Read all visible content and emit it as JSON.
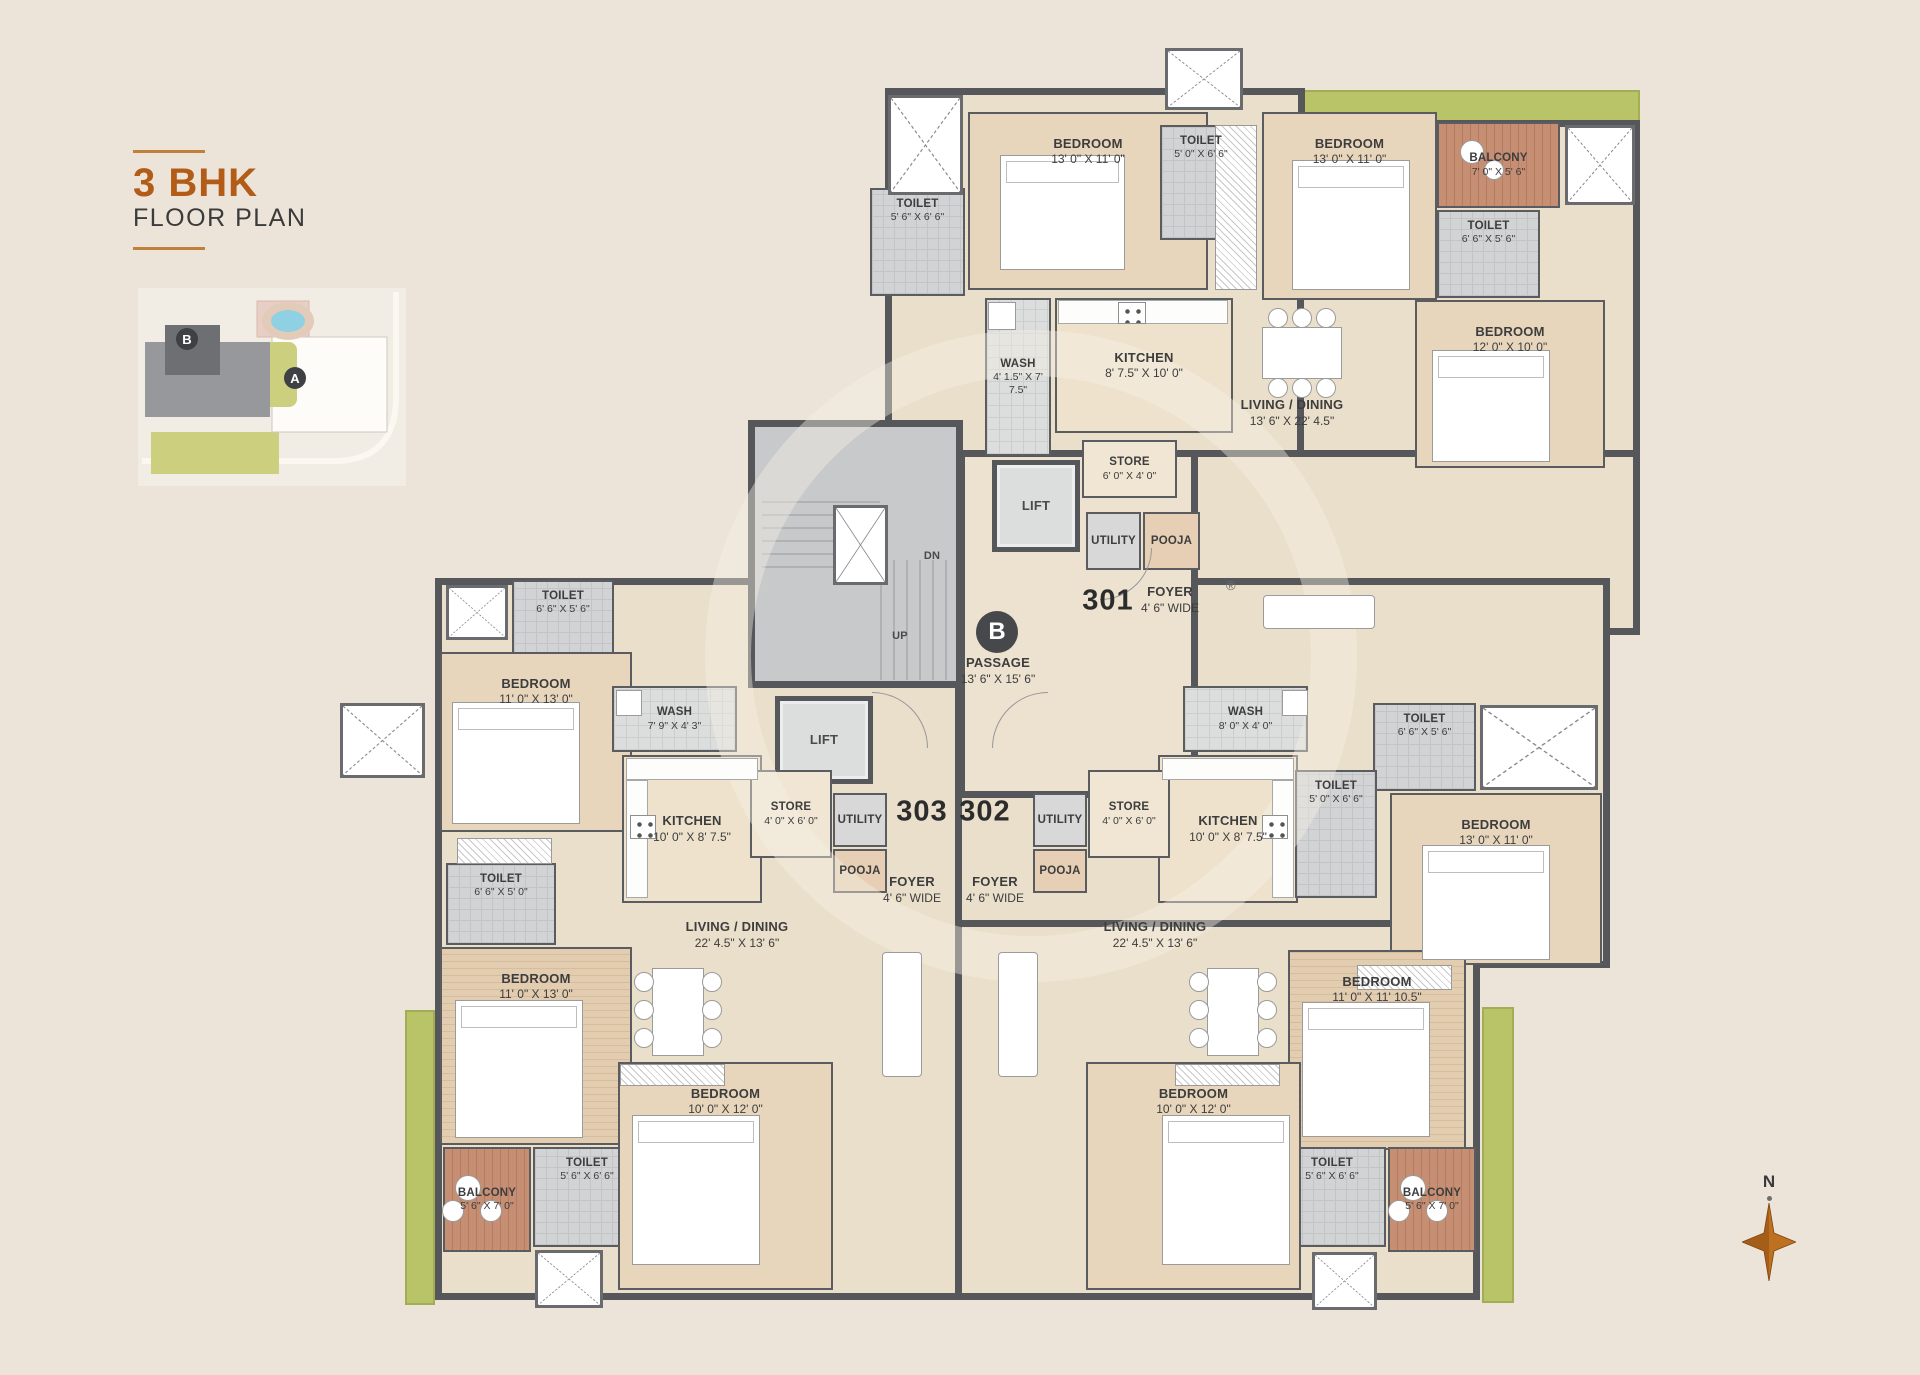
{
  "title": {
    "main": "3 BHK",
    "sub": "FLOOR PLAN"
  },
  "compass": {
    "label": "N"
  },
  "sitemap": {
    "badge_b": "B",
    "badge_a": "A"
  },
  "watermark": {
    "reg": "®"
  },
  "floorplan": {
    "wall_color": "#56575a",
    "accent_orange": "#b35c17",
    "green_color": "#b9c469",
    "rooms": [
      {
        "id": "toilet-301-a",
        "unit": "301",
        "type": "toilet",
        "name": "TOILET",
        "dims": "5' 6\" X 6' 6\"",
        "x": 870,
        "y": 188,
        "w": 95,
        "h": 108
      },
      {
        "id": "bedroom-301-a",
        "unit": "301",
        "type": "bedroom",
        "name": "BEDROOM",
        "dims": "13' 0\" X 11' 0\"",
        "x": 968,
        "y": 112,
        "w": 240,
        "h": 178
      },
      {
        "id": "toilet-301-b",
        "unit": "301",
        "type": "toilet",
        "name": "TOILET",
        "dims": "5' 0\" X 6' 6\"",
        "x": 1160,
        "y": 125,
        "w": 82,
        "h": 115
      },
      {
        "id": "bedroom-301-b",
        "unit": "301",
        "type": "bedroom",
        "name": "BEDROOM",
        "dims": "13' 0\" X 11' 0\"",
        "x": 1262,
        "y": 112,
        "w": 175,
        "h": 188
      },
      {
        "id": "balcony-301",
        "unit": "301",
        "type": "balcony",
        "name": "BALCONY",
        "dims": "7' 0\" X 5' 6\"",
        "x": 1437,
        "y": 122,
        "w": 123,
        "h": 86
      },
      {
        "id": "toilet-301-c",
        "unit": "301",
        "type": "toilet",
        "name": "TOILET",
        "dims": "6' 6\" X 5' 6\"",
        "x": 1437,
        "y": 210,
        "w": 103,
        "h": 88
      },
      {
        "id": "bedroom-301-c",
        "unit": "301",
        "type": "bedroom",
        "name": "BEDROOM",
        "dims": "12' 0\" X 10' 0\"",
        "x": 1415,
        "y": 300,
        "w": 190,
        "h": 168
      },
      {
        "id": "wash-301",
        "unit": "301",
        "type": "wash",
        "name": "WASH",
        "dims": "4' 1.5\" X 7' 7.5\"",
        "x": 985,
        "y": 298,
        "w": 66,
        "h": 158
      },
      {
        "id": "kitchen-301",
        "unit": "301",
        "type": "kitchen",
        "name": "KITCHEN",
        "dims": "8' 7.5\" X 10' 0\"",
        "x": 1055,
        "y": 298,
        "w": 178,
        "h": 135
      },
      {
        "id": "store-301",
        "unit": "301",
        "type": "store",
        "name": "STORE",
        "dims": "6' 0\" X 4' 0\"",
        "x": 1082,
        "y": 440,
        "w": 95,
        "h": 58
      },
      {
        "id": "utility-301",
        "unit": "301",
        "type": "utility",
        "name": "UTILITY",
        "dims": "",
        "x": 1086,
        "y": 512,
        "w": 55,
        "h": 58
      },
      {
        "id": "pooja-301",
        "unit": "301",
        "type": "pooja",
        "name": "POOJA",
        "dims": "",
        "x": 1143,
        "y": 512,
        "w": 57,
        "h": 58
      },
      {
        "id": "living-301",
        "unit": "301",
        "type": "label",
        "name": "LIVING / DINING",
        "dims": "13' 6\" X 22' 4.5\"",
        "x": 1212,
        "y": 383,
        "w": 160,
        "h": 60
      },
      {
        "id": "foyer-301",
        "unit": "301",
        "type": "label",
        "name": "FOYER",
        "dims": "4' 6\" WIDE",
        "x": 1125,
        "y": 575,
        "w": 90,
        "h": 50
      },
      {
        "id": "lift-upper",
        "unit": "core",
        "type": "lift",
        "name": "LIFT",
        "dims": "",
        "x": 992,
        "y": 460,
        "w": 88,
        "h": 92
      },
      {
        "id": "lift-lower",
        "unit": "core",
        "type": "lift",
        "name": "LIFT",
        "dims": "",
        "x": 775,
        "y": 696,
        "w": 98,
        "h": 88
      },
      {
        "id": "passage",
        "unit": "core",
        "type": "label",
        "name": "PASSAGE",
        "dims": "13' 6\" X 15' 6\"",
        "x": 943,
        "y": 648,
        "w": 110,
        "h": 46
      },
      {
        "id": "up-marker",
        "unit": "core",
        "type": "tiny",
        "name": "UP",
        "dims": "",
        "x": 880,
        "y": 628,
        "w": 40,
        "h": 18
      },
      {
        "id": "dn-marker",
        "unit": "core",
        "type": "tiny",
        "name": "DN",
        "dims": "",
        "x": 912,
        "y": 548,
        "w": 40,
        "h": 18
      },
      {
        "id": "toilet-303-a",
        "unit": "303",
        "type": "toilet",
        "name": "TOILET",
        "dims": "6' 6\" X 5' 6\"",
        "x": 512,
        "y": 580,
        "w": 102,
        "h": 88
      },
      {
        "id": "bedroom-303-a",
        "unit": "303",
        "type": "bedroom",
        "name": "BEDROOM",
        "dims": "11' 0\" X 13' 0\"",
        "x": 440,
        "y": 652,
        "w": 192,
        "h": 180
      },
      {
        "id": "wash-303",
        "unit": "303",
        "type": "wash",
        "name": "WASH",
        "dims": "7' 9\" X 4' 3\"",
        "x": 612,
        "y": 686,
        "w": 125,
        "h": 66
      },
      {
        "id": "kitchen-303",
        "unit": "303",
        "type": "kitchen",
        "name": "KITCHEN",
        "dims": "10' 0\" X 8' 7.5\"",
        "x": 622,
        "y": 755,
        "w": 140,
        "h": 148
      },
      {
        "id": "store-303",
        "unit": "303",
        "type": "store",
        "name": "STORE",
        "dims": "4' 0\" X 6' 0\"",
        "x": 750,
        "y": 770,
        "w": 82,
        "h": 88
      },
      {
        "id": "utility-303",
        "unit": "303",
        "type": "utility",
        "name": "UTILITY",
        "dims": "",
        "x": 833,
        "y": 793,
        "w": 54,
        "h": 54
      },
      {
        "id": "pooja-303",
        "unit": "303",
        "type": "pooja",
        "name": "POOJA",
        "dims": "",
        "x": 833,
        "y": 849,
        "w": 54,
        "h": 44
      },
      {
        "id": "toilet-303-b",
        "unit": "303",
        "type": "toilet",
        "name": "TOILET",
        "dims": "6' 6\" X 5' 0\"",
        "x": 446,
        "y": 863,
        "w": 110,
        "h": 82
      },
      {
        "id": "bedroom-303-b",
        "unit": "303",
        "type": "bedroom-wood",
        "name": "BEDROOM",
        "dims": "11' 0\" X 13' 0\"",
        "x": 440,
        "y": 947,
        "w": 192,
        "h": 198
      },
      {
        "id": "balcony-303",
        "unit": "303",
        "type": "balcony",
        "name": "BALCONY",
        "dims": "5' 6\" X 7' 0\"",
        "x": 443,
        "y": 1147,
        "w": 88,
        "h": 105
      },
      {
        "id": "toilet-303-c",
        "unit": "303",
        "type": "toilet",
        "name": "TOILET",
        "dims": "5' 6\" X 6' 6\"",
        "x": 533,
        "y": 1147,
        "w": 108,
        "h": 100
      },
      {
        "id": "bedroom-303-c",
        "unit": "303",
        "type": "bedroom",
        "name": "BEDROOM",
        "dims": "10' 0\" X 12' 0\"",
        "x": 618,
        "y": 1062,
        "w": 215,
        "h": 228
      },
      {
        "id": "living-303",
        "unit": "303",
        "type": "label",
        "name": "LIVING / DINING",
        "dims": "22' 4.5\" X 13' 6\"",
        "x": 657,
        "y": 905,
        "w": 160,
        "h": 60
      },
      {
        "id": "foyer-303",
        "unit": "303",
        "type": "label",
        "name": "FOYER",
        "dims": "4' 6\" WIDE",
        "x": 867,
        "y": 865,
        "w": 90,
        "h": 50
      },
      {
        "id": "wash-302",
        "unit": "302",
        "type": "wash",
        "name": "WASH",
        "dims": "8' 0\" X 4' 0\"",
        "x": 1183,
        "y": 686,
        "w": 125,
        "h": 66
      },
      {
        "id": "kitchen-302",
        "unit": "302",
        "type": "kitchen",
        "name": "KITCHEN",
        "dims": "10' 0\" X 8' 7.5\"",
        "x": 1158,
        "y": 755,
        "w": 140,
        "h": 148
      },
      {
        "id": "store-302",
        "unit": "302",
        "type": "store",
        "name": "STORE",
        "dims": "4' 0\" X 6' 0\"",
        "x": 1088,
        "y": 770,
        "w": 82,
        "h": 88
      },
      {
        "id": "utility-302",
        "unit": "302",
        "type": "utility",
        "name": "UTILITY",
        "dims": "",
        "x": 1033,
        "y": 793,
        "w": 54,
        "h": 54
      },
      {
        "id": "pooja-302",
        "unit": "302",
        "type": "pooja",
        "name": "POOJA",
        "dims": "",
        "x": 1033,
        "y": 849,
        "w": 54,
        "h": 44
      },
      {
        "id": "toilet-302-a",
        "unit": "302",
        "type": "toilet",
        "name": "TOILET",
        "dims": "6' 6\" X 5' 6\"",
        "x": 1373,
        "y": 703,
        "w": 103,
        "h": 88
      },
      {
        "id": "toilet-302-b",
        "unit": "302",
        "type": "toilet",
        "name": "TOILET",
        "dims": "5' 0\" X 6' 6\"",
        "x": 1295,
        "y": 770,
        "w": 82,
        "h": 128
      },
      {
        "id": "bedroom-302-a",
        "unit": "302",
        "type": "bedroom",
        "name": "BEDROOM",
        "dims": "13' 0\" X 11' 0\"",
        "x": 1390,
        "y": 793,
        "w": 212,
        "h": 172
      },
      {
        "id": "bedroom-302-b",
        "unit": "302",
        "type": "bedroom-wood",
        "name": "BEDROOM",
        "dims": "11' 0\" X 11' 10.5\"",
        "x": 1288,
        "y": 950,
        "w": 178,
        "h": 200
      },
      {
        "id": "living-302",
        "unit": "302",
        "type": "label",
        "name": "LIVING / DINING",
        "dims": "22' 4.5\" X 13' 6\"",
        "x": 1075,
        "y": 905,
        "w": 160,
        "h": 60
      },
      {
        "id": "foyer-302",
        "unit": "302",
        "type": "label",
        "name": "FOYER",
        "dims": "4' 6\" WIDE",
        "x": 950,
        "y": 865,
        "w": 90,
        "h": 50
      },
      {
        "id": "balcony-302",
        "unit": "302",
        "type": "balcony",
        "name": "BALCONY",
        "dims": "5' 6\" X 7' 0\"",
        "x": 1388,
        "y": 1147,
        "w": 88,
        "h": 105
      },
      {
        "id": "toilet-302-c",
        "unit": "302",
        "type": "toilet",
        "name": "TOILET",
        "dims": "5' 6\" X 6' 6\"",
        "x": 1278,
        "y": 1147,
        "w": 108,
        "h": 100
      },
      {
        "id": "bedroom-302-c",
        "unit": "302",
        "type": "bedroom",
        "name": "BEDROOM",
        "dims": "10' 0\" X 12' 0\"",
        "x": 1086,
        "y": 1062,
        "w": 215,
        "h": 228
      }
    ],
    "badges": [
      {
        "kind": "unitnum",
        "label": "301",
        "x": 1108,
        "y": 601
      },
      {
        "kind": "unitnum",
        "label": "303",
        "x": 922,
        "y": 812
      },
      {
        "kind": "unitnum",
        "label": "302",
        "x": 985,
        "y": 812
      },
      {
        "kind": "bcircle",
        "label": "B",
        "x": 997,
        "y": 632
      }
    ]
  }
}
